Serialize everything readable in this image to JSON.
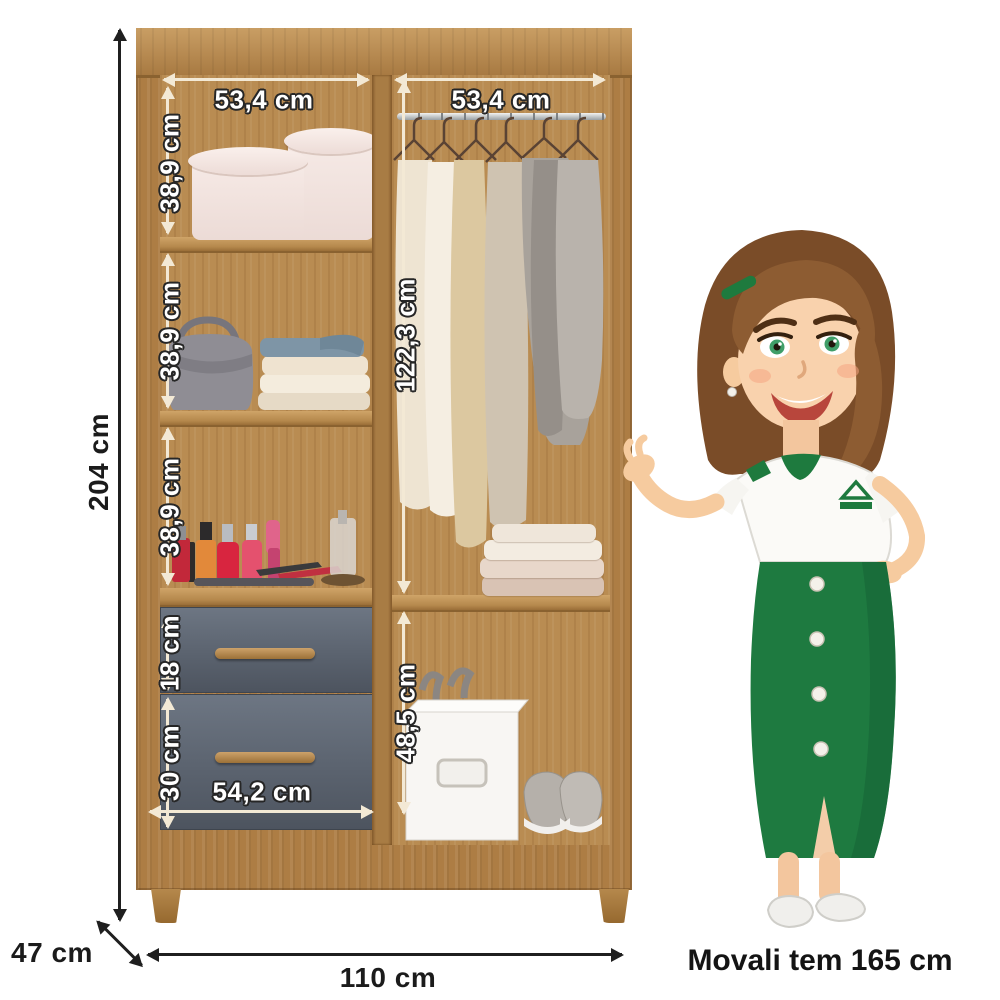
{
  "caption": "Movali tem 165 cm",
  "dimensions": {
    "total_height": "204 cm",
    "total_width": "110 cm",
    "depth": "47 cm",
    "left_section_width": "53,4 cm",
    "right_section_width": "53,4 cm",
    "upper_shelf_height": "38,9 cm",
    "middle_shelf_height": "38,9 cm",
    "lower_shelf_height": "38,9 cm",
    "hanging_space_height": "122,3 cm",
    "top_drawer_height": "18 cm",
    "bottom_drawer_height": "30 cm",
    "drawer_width": "54,2 cm",
    "shoe_space_height": "48,5 cm"
  },
  "colors": {
    "wood": "#b5874c",
    "wood_dark": "#8a6230",
    "drawer_gray": "#5b636f",
    "annotation_cream": "#f3e9d5",
    "annotation_text": "#ffffff",
    "external_text": "#1b1b1b",
    "mascot_green": "#1e7a40",
    "mascot_hair": "#8a5a33"
  }
}
